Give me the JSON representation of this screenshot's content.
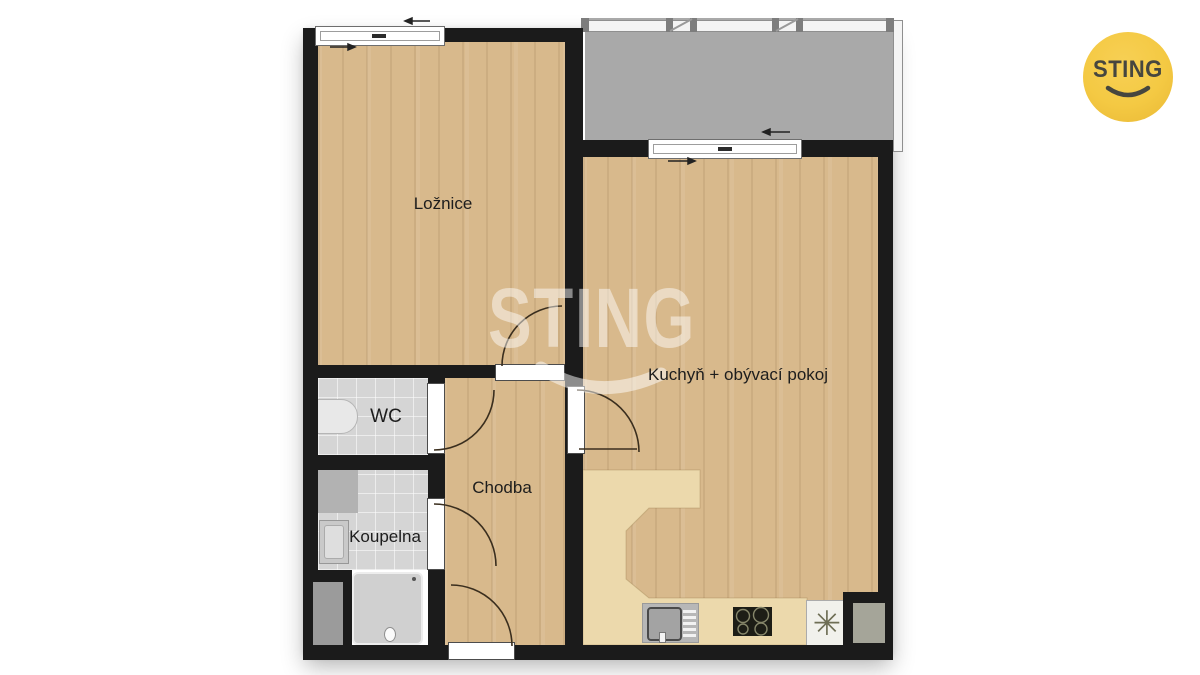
{
  "brand": {
    "logo_text": "STING",
    "watermark_text": "STING"
  },
  "rooms": {
    "bedroom": {
      "label": "Ložnice"
    },
    "wc": {
      "label": "WC"
    },
    "bathroom": {
      "label": "Koupelna"
    },
    "hallway": {
      "label": "Chodba"
    },
    "kitchen_living": {
      "label": "Kuchyň + obývací pokoj"
    }
  },
  "symbols": {
    "fridge_icon": "✳"
  },
  "colors": {
    "wall": "#1B1B1B",
    "wood_floor": "#D8B98C",
    "kitchen_counter": "#ECD9AC",
    "tile_floor": "#D5D5D5",
    "balcony": "#A9A9A9",
    "logo_yellow": "#F4C943",
    "logo_text_color": "#46463F"
  }
}
